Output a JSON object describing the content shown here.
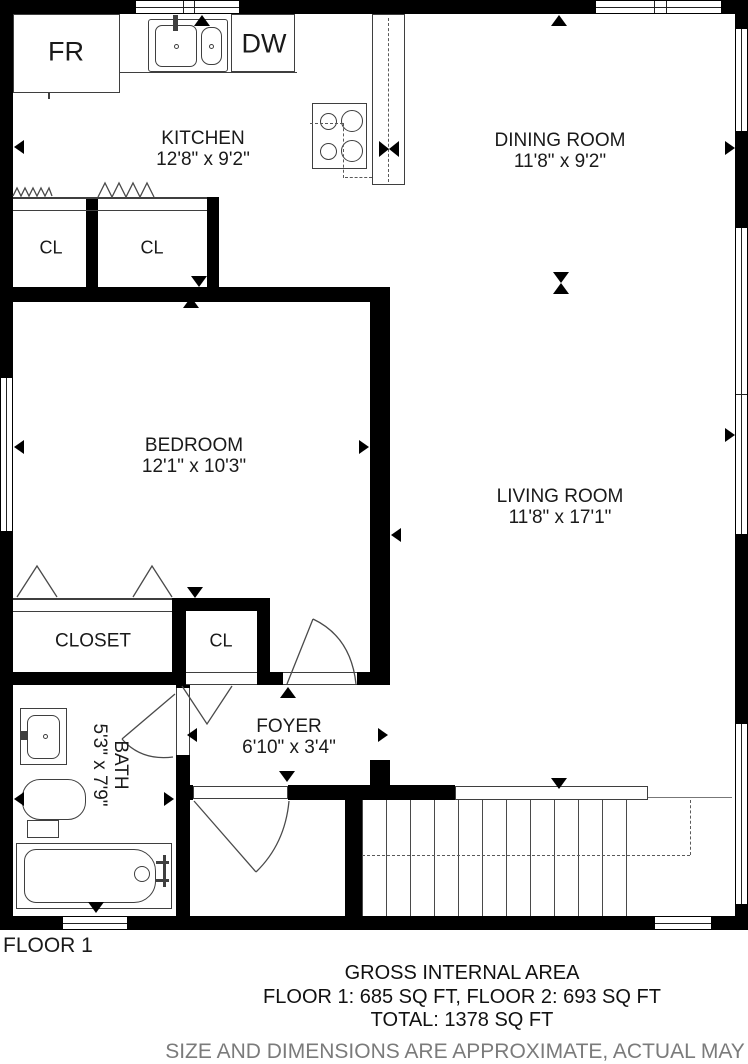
{
  "plan": {
    "floor_label": "FLOOR 1",
    "rooms": {
      "kitchen": {
        "name": "KITCHEN",
        "dims": "12'8\" x 9'2\""
      },
      "dining": {
        "name": "DINING ROOM",
        "dims": "11'8\" x 9'2\""
      },
      "bedroom": {
        "name": "BEDROOM",
        "dims": "12'1\" x 10'3\""
      },
      "living": {
        "name": "LIVING ROOM",
        "dims": "11'8\" x 17'1\""
      },
      "foyer": {
        "name": "FOYER",
        "dims": "6'10\" x 3'4\""
      },
      "bath": {
        "name": "BATH",
        "dims": "5'3\" x 7'9\""
      },
      "closet_main": {
        "name": "CLOSET"
      },
      "closet_hall_1": {
        "name": "CL"
      },
      "closet_hall_2": {
        "name": "CL"
      },
      "closet_foyer": {
        "name": "CL"
      }
    },
    "appliances": {
      "refrigerator": "FR",
      "dishwasher": "DW"
    },
    "symbols": [
      "kitchen-sink",
      "stove",
      "bathtub",
      "toilet",
      "vanity-sink",
      "staircase",
      "door-arc",
      "closet-rod",
      "window",
      "dimension-arrow"
    ]
  },
  "summary": {
    "title": "GROSS INTERNAL AREA",
    "floors": "FLOOR 1: 685 SQ FT, FLOOR 2: 693 SQ FT",
    "total": "TOTAL: 1378 SQ FT",
    "disclaimer": "SIZE AND DIMENSIONS ARE APPROXIMATE, ACTUAL MAY"
  },
  "colors": {
    "wall": "#000000",
    "line": "#3f3f3f",
    "text": "#1a1a1a",
    "disclaimer": "#7b7b7b",
    "background": "#ffffff"
  }
}
